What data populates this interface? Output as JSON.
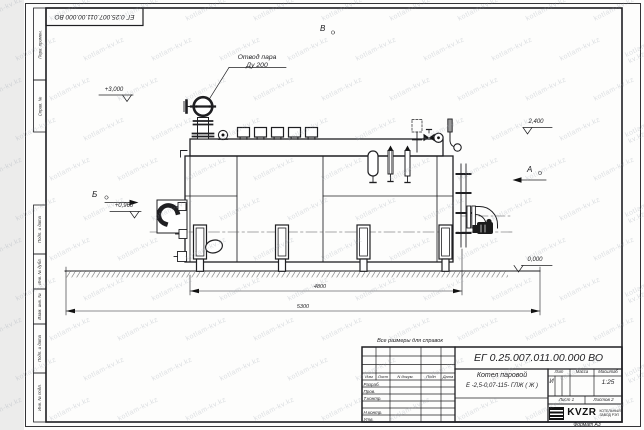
{
  "sheet": {
    "top_stamp": "ЕГ 0.25.007.011.00.000  ВО",
    "format_label": "Формат А3",
    "margin_labels": [
      "Перв. примен.",
      "Справ. №",
      "Подп. и дата",
      "Инв. № дубл.",
      "Взам. инв. №",
      "Подп. и дата",
      "Инв. № подл."
    ]
  },
  "watermark": {
    "text": "kotlam-kv.kz"
  },
  "drawing": {
    "callout": {
      "line1": "Отвод пара",
      "line2": "Ду 200"
    },
    "elevations": {
      "top": "+3,000",
      "right": "2,400",
      "mid": "+0,960",
      "ground": "0,000"
    },
    "views": {
      "a": "А",
      "b": "Б",
      "v": "В"
    },
    "dims": {
      "inner": "4800",
      "outer": "5300"
    }
  },
  "title_block": {
    "note": "Все размеры для справок",
    "doc_number": "ЕГ 0.25.007.011.00.000  ВО",
    "name_line1": "Котел паровой",
    "name_line2": "Е -2,5-0,07-115- ГЛЖ ( Ж )",
    "cols": {
      "izm": "Изм",
      "list": "Лист",
      "ndoc": "N докум.",
      "podp": "Подп",
      "data": "Дата"
    },
    "rows": [
      "Разраб.",
      "Пров.",
      "Т.контр.",
      "Н.контр.",
      "Утв."
    ],
    "lit": {
      "label": "Лит",
      "value": "И"
    },
    "massa": {
      "label": "Масса"
    },
    "scale": {
      "label": "Масштаб",
      "value": "1:25"
    },
    "sheet_no": {
      "label": "Лист",
      "value": "1"
    },
    "sheets_total": {
      "label": "Листов",
      "value": "2"
    },
    "company": {
      "logo": "KVZR",
      "line1": "КОТЕЛЬНЫЙ",
      "line2": "ЗАВОД РЭП"
    }
  }
}
